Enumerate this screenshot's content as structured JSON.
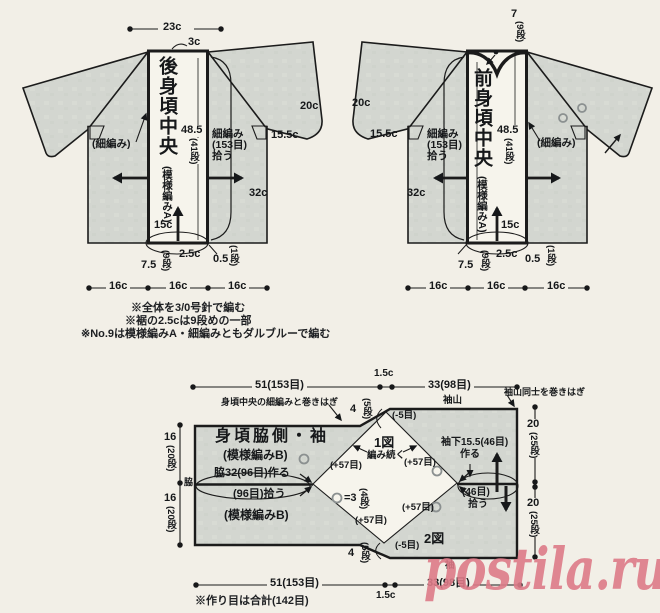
{
  "watermark": "postila.ru",
  "back": {
    "title": "後身頃中央",
    "pattern": "(模様編みA)",
    "dim_23c": "23c",
    "dim_3c": "3c",
    "len_val": "48.5",
    "len_rows": "(41段)",
    "pickup_l1": "細編み",
    "pickup_l2": "(153目)",
    "pickup_l3": "拾う",
    "sc_label": "(細編み)",
    "dim_20c": "20c",
    "dim_155c": "15.5c",
    "dim_32c": "32c",
    "dim_15c": "15c",
    "dim_25c": "2.5c",
    "dim_05": "0.5",
    "rows_1": "(1段)",
    "dim_75": "7.5",
    "rows_9": "(9段)",
    "dim_16c_1": "16c",
    "dim_16c_2": "16c",
    "dim_16c_3": "16c"
  },
  "front": {
    "title": "前身頃中央",
    "pattern": "(模様編みA)",
    "neck_val": "7",
    "neck_rows": "(9段)",
    "len_val": "48.5",
    "len_rows": "(41段)",
    "pickup_l1": "細編み",
    "pickup_l2": "(153目)",
    "pickup_l3": "拾う",
    "sc_label": "(細編み)",
    "dim_20c": "20c",
    "dim_155c": "15.5c",
    "dim_32c": "32c",
    "dim_15c": "15c",
    "dim_25c": "2.5c",
    "dim_05": "0.5",
    "rows_1": "(1段)",
    "dim_75": "7.5",
    "rows_9": "(9段)",
    "dim_16c_1": "16c",
    "dim_16c_2": "16c",
    "dim_16c_3": "16c"
  },
  "notes": {
    "n1": "※全体を3/0号針で編む",
    "n2": "※裾の2.5cは9段めの一部",
    "n3": "※No.9は模様編みA・細編みともダルブルーで編む"
  },
  "lower": {
    "title": "身頃脇側・袖",
    "pattern_top": "(模様編みB)",
    "pattern_bottom": "(模様編みB)",
    "side_make": "脇32(96目)作る",
    "side_pick": "(96目)拾う",
    "fig1": "1図",
    "fig2": "2図",
    "knit_cont": "編み続く",
    "plus57_tl": "(+57目)",
    "plus57_tr": "(+57目)",
    "plus57_bl": "(+57目)",
    "plus57_br": "(+57目)",
    "minus5_top": "(-5目)",
    "minus5_bottom": "(-5目)",
    "legend_eq": "=3",
    "legend_rows": "(4段)",
    "sleeve_under_l1": "袖下15.5(46目)",
    "sleeve_under_l2": "作る",
    "pick46_l1": "(46目)",
    "pick46_l2": "拾う",
    "sodeyama": "袖山",
    "sodeyama_join": "袖山同士を巻きはぎ",
    "center_join": "身頃中央の細編みと巻きはぎ",
    "sode": "袖",
    "waki": "脇",
    "dim_top_51": "51(153目)",
    "dim_top_15c": "1.5c",
    "dim_top_33": "33(98目)",
    "dim_bot_51": "51(153目)",
    "dim_bot_15c": "1.5c",
    "dim_bot_33": "33(98目)",
    "rows16_1_val": "16",
    "rows16_1_rows": "(20段)",
    "rows16_2_val": "16",
    "rows16_2_rows": "(20段)",
    "rows20_1_val": "20",
    "rows20_1_rows": "(25段)",
    "rows20_2_val": "20",
    "rows20_2_rows": "(25段)",
    "step4_top_val": "4",
    "step4_top_rows": "(5段)",
    "step4_bot_val": "4",
    "step4_bot_rows": "(5段)",
    "note": "※作り目は合計(142目)"
  }
}
